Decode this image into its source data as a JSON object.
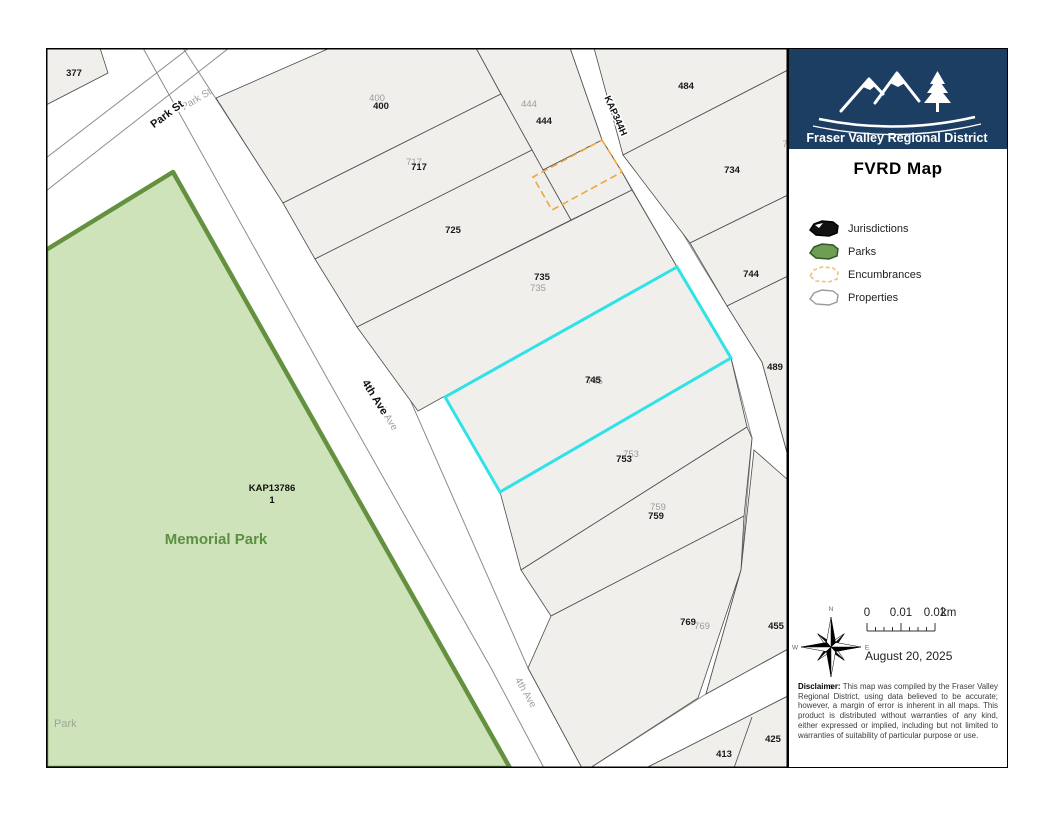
{
  "map": {
    "parcels": [
      "377",
      "400",
      "444",
      "484",
      "717",
      "734",
      "725",
      "735",
      "744",
      "745",
      "489",
      "753",
      "759",
      "769",
      "455",
      "413",
      "425"
    ],
    "selected_parcel": "745",
    "edge_fragment": "7",
    "streets": {
      "park_st": "Park St",
      "fourth_ave": "4th Ave",
      "kap344h": "KAP344H"
    },
    "park": {
      "plan": "KAP13786",
      "lot": "1",
      "name": "Memorial Park",
      "corner_label": "Park"
    }
  },
  "panel": {
    "org": "Fraser Valley Regional District",
    "title": "FVRD Map",
    "legend": [
      {
        "label": "Jurisdictions"
      },
      {
        "label": "Parks"
      },
      {
        "label": "Encumbrances"
      },
      {
        "label": "Properties"
      }
    ],
    "compass": {
      "n": "N",
      "e": "E",
      "s": "S",
      "w": "W"
    },
    "scale": {
      "t0": "0",
      "t1": "0.01",
      "t2": "0.02",
      "unit": "km"
    },
    "date": "August 20, 2025",
    "disclaimer_heading": "Disclaimer:",
    "disclaimer_body": " This map was compiled by the Fraser Valley Regional District, using data believed to be accurate; however, a margin of error is inherent in all maps. This product is distributed without warranties of any kind, either expressed or implied, including but not limited to warranties of suitability of particular purpose or use."
  },
  "colors": {
    "selection_cyan": "#2fe2e8",
    "encumbrance_orange": "#f0a63c",
    "park_fill": "#cfe3ba",
    "park_stroke": "#63913f",
    "parcel_fill": "#f0efec",
    "brand_navy": "#1d3e63"
  }
}
